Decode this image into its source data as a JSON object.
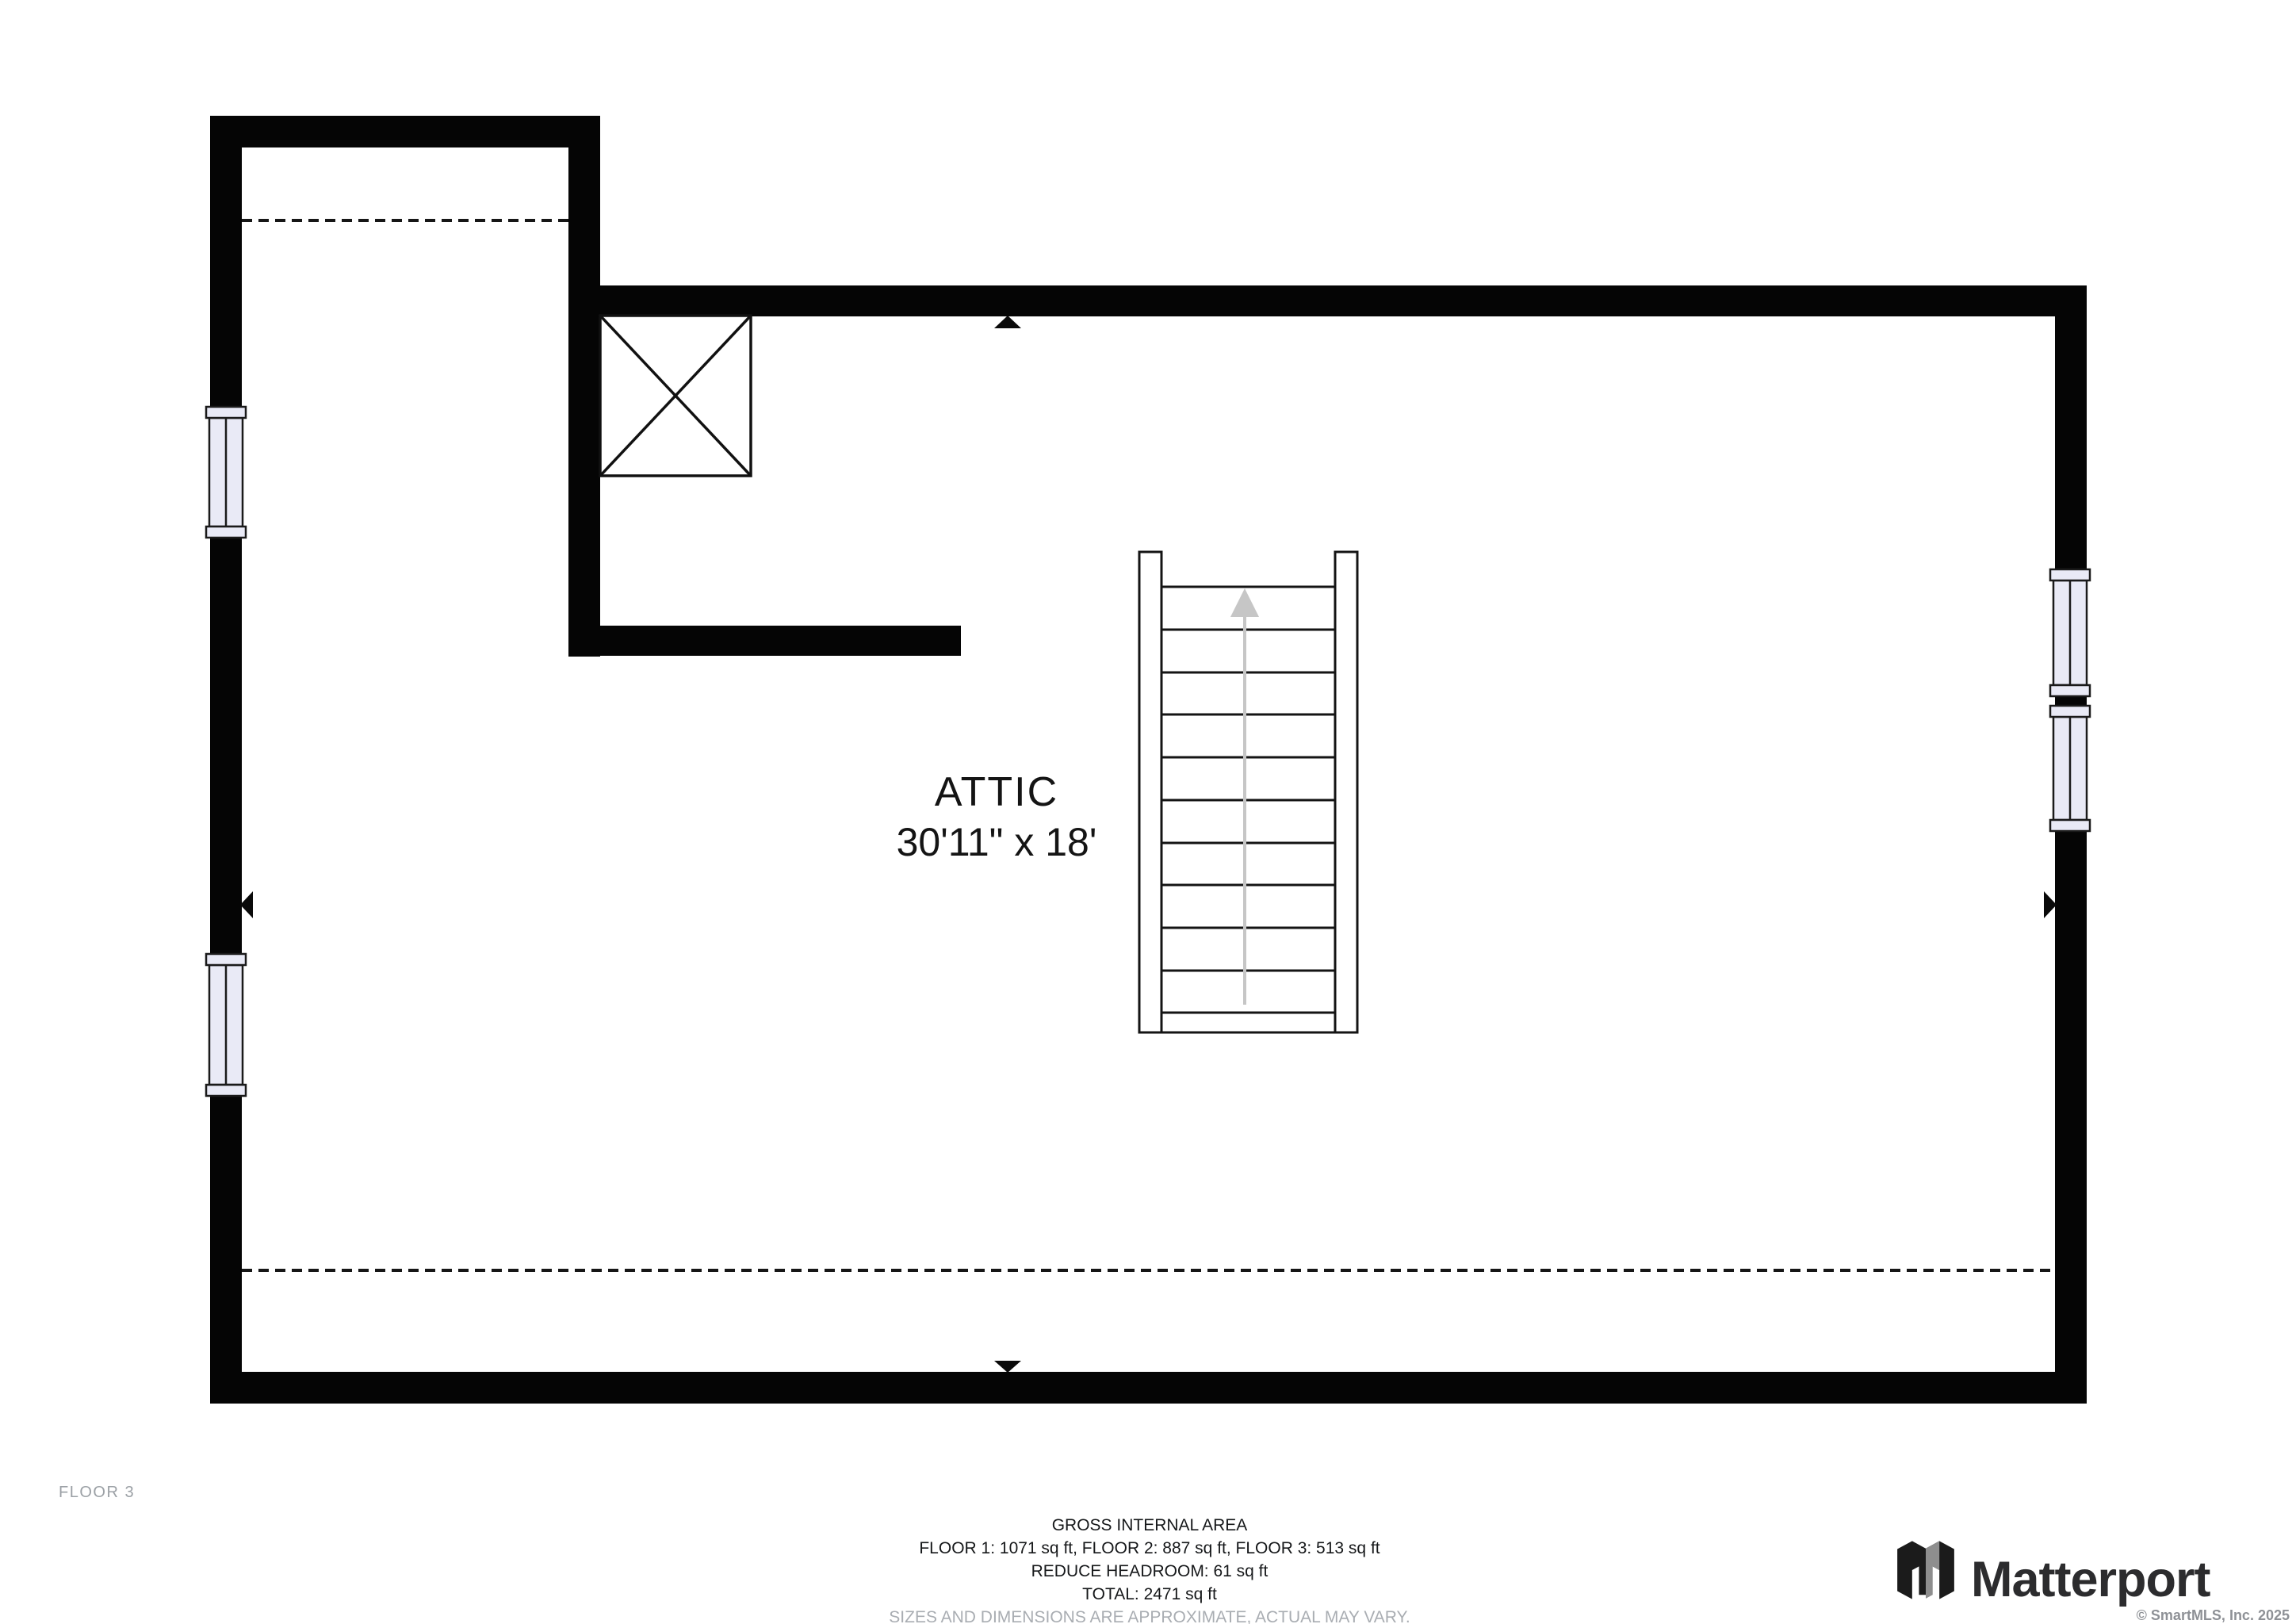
{
  "floorplan": {
    "room": {
      "name": "ATTIC",
      "dimensions": "30'11\" x 18'"
    },
    "floor_label": "FLOOR 3",
    "features": {
      "stairs": {
        "icon": "stairs-up-arrow",
        "direction": "up",
        "treads": 12
      },
      "chimney_icon": "x-box-shaft",
      "window_icon": "window-symbol",
      "window_count": 4,
      "wall_marker_icon": "wall-marker-triangle",
      "dashed_line_icon": "headroom-dashed-line"
    },
    "colors": {
      "wall": "#050505",
      "window_fill": "#e9eaf6",
      "stair_arrow": "#c6c6c6",
      "text": "#141414",
      "muted_text": "#9ba0a5",
      "disclaimer_text": "#a9adb2"
    }
  },
  "footer": {
    "area_summary": {
      "title": "GROSS INTERNAL AREA",
      "floors": "FLOOR 1: 1071 sq ft, FLOOR 2: 887 sq ft, FLOOR 3: 513 sq ft",
      "reduce_headroom": "REDUCE HEADROOM: 61 sq ft",
      "total": "TOTAL: 2471 sq ft",
      "disclaimer": "SIZES AND DIMENSIONS ARE APPROXIMATE, ACTUAL MAY VARY."
    },
    "branding": {
      "logo": "Matterport",
      "logo_icon": "matterport-logo-icon",
      "copyright": "© SmartMLS, Inc. 2025"
    }
  }
}
